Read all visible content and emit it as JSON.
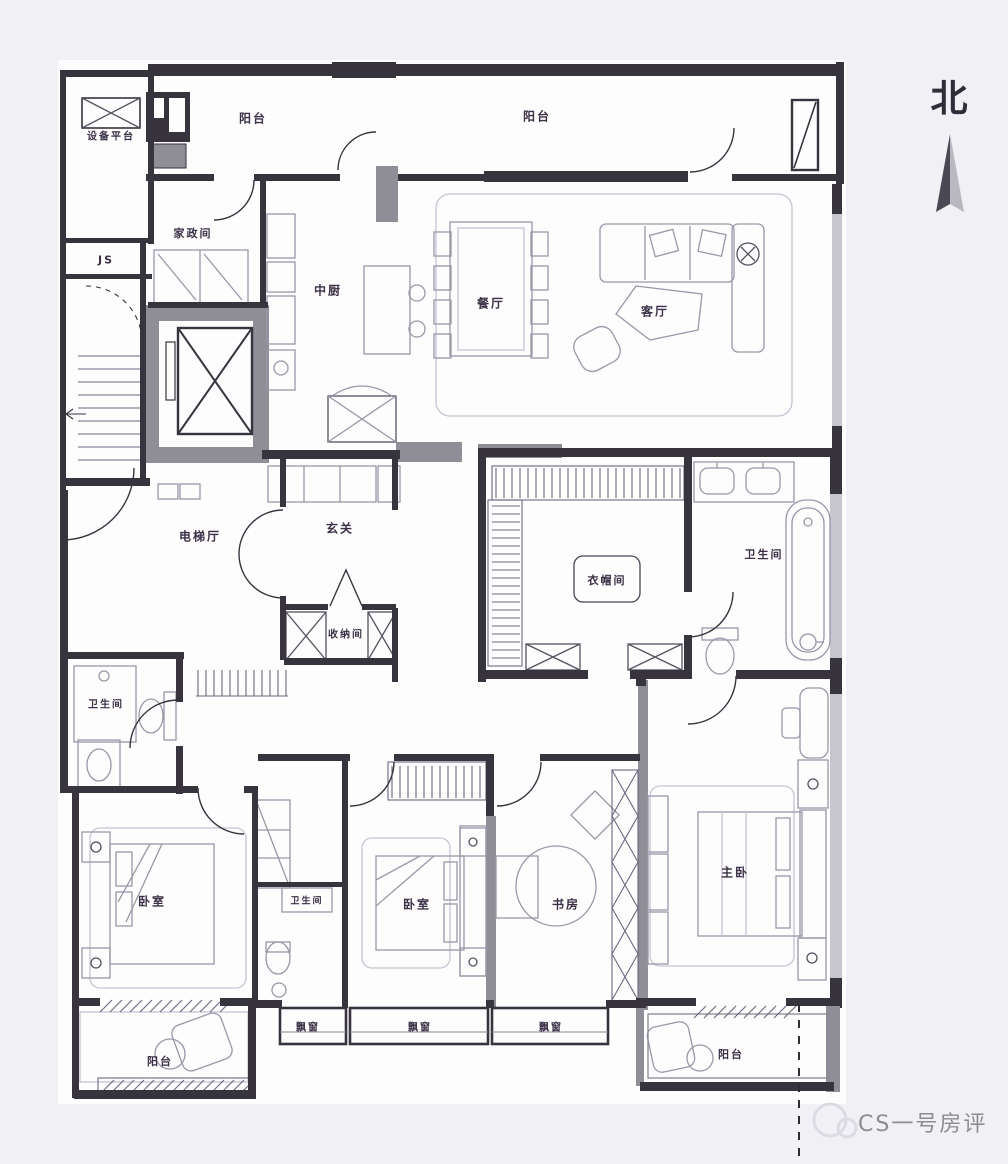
{
  "page": {
    "background": "#f1f0f4"
  },
  "plan": {
    "type": "apartment-floor-plan",
    "wall_color": "#38343e",
    "label_color": "#3b3046",
    "rooms": [
      {
        "id": "equipment-platform",
        "label": "设备平台",
        "x": 111,
        "y": 135,
        "fs": 10
      },
      {
        "id": "balcony-top-left",
        "label": "阳台",
        "x": 253,
        "y": 118,
        "fs": 12
      },
      {
        "id": "balcony-top",
        "label": "阳台",
        "x": 537,
        "y": 116,
        "fs": 12
      },
      {
        "id": "housekeeping-room",
        "label": "家政间",
        "x": 193,
        "y": 233,
        "fs": 11
      },
      {
        "id": "js-shaft",
        "label": "JS",
        "x": 106,
        "y": 260,
        "fs": 11
      },
      {
        "id": "kitchen",
        "label": "中厨",
        "x": 328,
        "y": 290,
        "fs": 12
      },
      {
        "id": "dining-room",
        "label": "餐厅",
        "x": 491,
        "y": 303,
        "fs": 12
      },
      {
        "id": "living-room",
        "label": "客厅",
        "x": 655,
        "y": 311,
        "fs": 12
      },
      {
        "id": "elevator-hall",
        "label": "电梯厅",
        "x": 200,
        "y": 536,
        "fs": 12
      },
      {
        "id": "foyer",
        "label": "玄关",
        "x": 340,
        "y": 528,
        "fs": 12
      },
      {
        "id": "storage-room",
        "label": "收纳间",
        "x": 346,
        "y": 633,
        "fs": 10
      },
      {
        "id": "walk-in-closet",
        "label": "衣帽间",
        "x": 607,
        "y": 580,
        "fs": 11
      },
      {
        "id": "master-bathroom",
        "label": "卫生间",
        "x": 764,
        "y": 554,
        "fs": 11
      },
      {
        "id": "guest-bathroom",
        "label": "卫生间",
        "x": 106,
        "y": 703,
        "fs": 10
      },
      {
        "id": "bedroom-left",
        "label": "卧室",
        "x": 152,
        "y": 901,
        "fs": 12
      },
      {
        "id": "bathroom-middle",
        "label": "卫生间",
        "x": 307,
        "y": 900,
        "fs": 9
      },
      {
        "id": "bedroom-middle",
        "label": "卧室",
        "x": 417,
        "y": 904,
        "fs": 12
      },
      {
        "id": "study",
        "label": "书房",
        "x": 566,
        "y": 904,
        "fs": 12
      },
      {
        "id": "master-bedroom",
        "label": "主卧",
        "x": 735,
        "y": 872,
        "fs": 12
      },
      {
        "id": "bay-window-left",
        "label": "飘窗",
        "x": 308,
        "y": 1026,
        "fs": 10
      },
      {
        "id": "bay-window-middle",
        "label": "飘窗",
        "x": 420,
        "y": 1026,
        "fs": 10
      },
      {
        "id": "bay-window-right",
        "label": "飘窗",
        "x": 551,
        "y": 1026,
        "fs": 10
      },
      {
        "id": "balcony-bottom-left",
        "label": "阳台",
        "x": 160,
        "y": 1061,
        "fs": 11
      },
      {
        "id": "balcony-bottom-right",
        "label": "阳台",
        "x": 731,
        "y": 1054,
        "fs": 11
      }
    ]
  },
  "compass": {
    "label": "北"
  },
  "watermark": {
    "text": "CS一号房评",
    "color": "#8d8c92"
  }
}
